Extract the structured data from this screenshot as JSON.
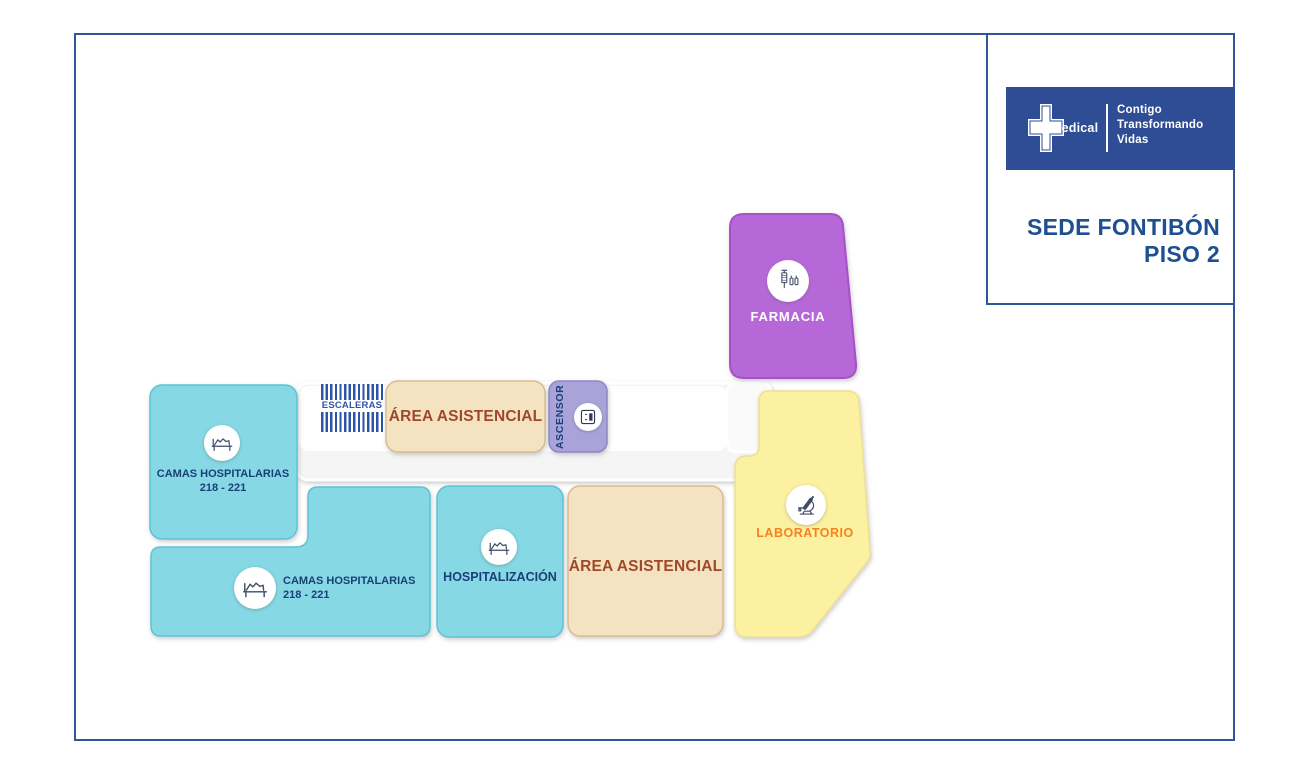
{
  "panel": {
    "brand": {
      "logo_text": "Medical",
      "tagline": [
        "Contigo",
        "Transformando",
        "Vidas"
      ]
    },
    "site_title": "SEDE FONTIBÓN",
    "floor_title": "PISO 2"
  },
  "rooms": {
    "farmacia": {
      "label": "FARMACIA"
    },
    "laboratorio": {
      "label": "LABORATORIO"
    },
    "escaleras": {
      "label": "ESCALERAS"
    },
    "ascensor": {
      "label": "ASCENSOR"
    },
    "area_asistencial_norte": {
      "label": "ÁREA ASISTENCIAL"
    },
    "area_asistencial_sur": {
      "label": "ÁREA ASISTENCIAL"
    },
    "camas_hospitalarias_a": {
      "label": "CAMAS HOSPITALARIAS",
      "sublabel": "218 - 221"
    },
    "camas_hospitalarias_b": {
      "label": "CAMAS HOSPITALARIAS",
      "sublabel": "218 - 221"
    },
    "hospitalizacion": {
      "label": "HOSPITALIZACIÓN"
    }
  },
  "colors": {
    "frame_blue": "#2e5597",
    "banner_blue": "#2e4d95",
    "title_blue": "#1d4f91",
    "navy_text": "#1b3f77",
    "brown_text": "#a0482a",
    "orange_text": "#f5821f",
    "stripe_blue": "#2d55a7",
    "cyan_room": "#85d8e4",
    "tan_room": "#f4e3c0",
    "yellow_room": "#fcf1a1",
    "purple_room": "#b767d8",
    "lilac_room": "#aaa3d9",
    "corridor_gray": "#f5f5f6"
  }
}
